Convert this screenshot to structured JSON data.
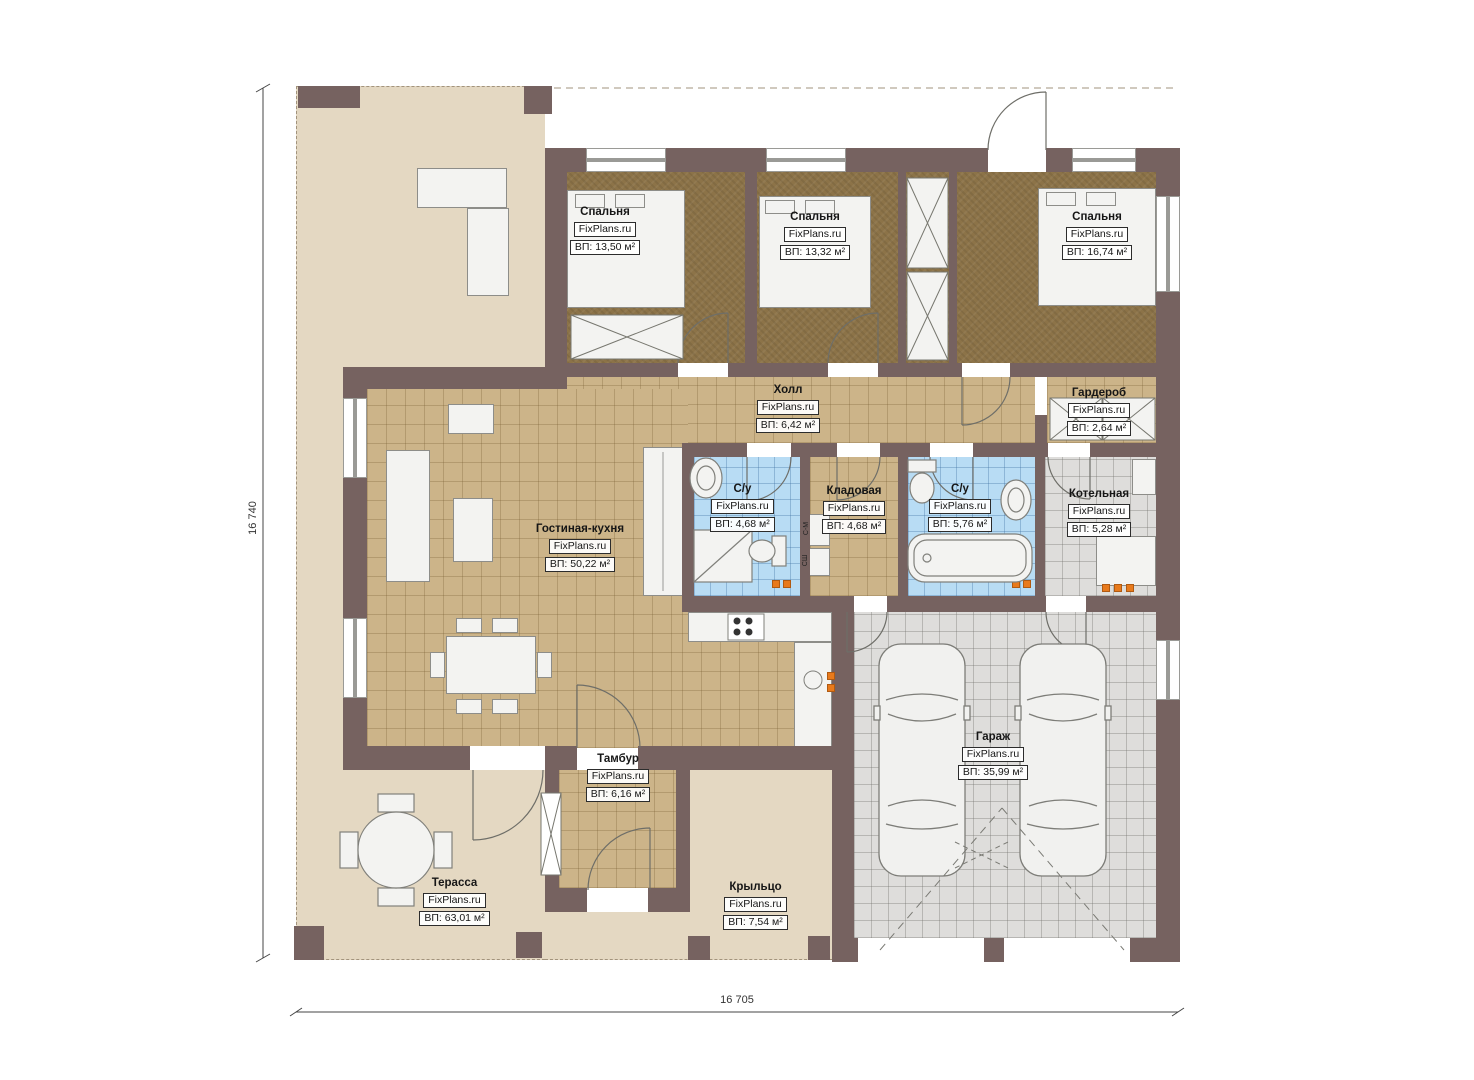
{
  "watermark": "FixPlans.ru",
  "dimensions": {
    "left": "16 740",
    "bottom": "16 705"
  },
  "rooms": [
    {
      "name": "Спальня",
      "area": "ВП: 13,50 м²"
    },
    {
      "name": "Спальня",
      "area": "ВП: 13,32 м²"
    },
    {
      "name": "Спальня",
      "area": "ВП: 16,74 м²"
    },
    {
      "name": "Холл",
      "area": "ВП: 6,42 м²"
    },
    {
      "name": "Гардероб",
      "area": "ВП: 2,64 м²"
    },
    {
      "name": "С/у",
      "area": "ВП: 4,68 м²"
    },
    {
      "name": "Кладовая",
      "area": "ВП: 4,68 м²"
    },
    {
      "name": "С/у",
      "area": "ВП: 5,76 м²"
    },
    {
      "name": "Котельная",
      "area": "ВП: 5,28 м²"
    },
    {
      "name": "Гостиная-кухня",
      "area": "ВП: 50,22 м²"
    },
    {
      "name": "Тамбур",
      "area": "ВП: 6,16 м²"
    },
    {
      "name": "Гараж",
      "area": "ВП: 35,99 м²"
    },
    {
      "name": "Терасса",
      "area": "ВП: 63,01 м²"
    },
    {
      "name": "Крыльцо",
      "area": "ВП: 7,54 м²"
    }
  ],
  "appliances": [
    "С-М",
    "СШ"
  ],
  "colors": {
    "wall": "#766260",
    "terrace": "#e4d8c2",
    "tile-tan": "#ccb489",
    "tile-blue": "#b8dcf4",
    "tile-gray": "#dedddb",
    "carpet": "#8c7348",
    "fixture": "#f3f3f1",
    "accent-orange": "#e87a1c",
    "line": "#6e6e68"
  }
}
